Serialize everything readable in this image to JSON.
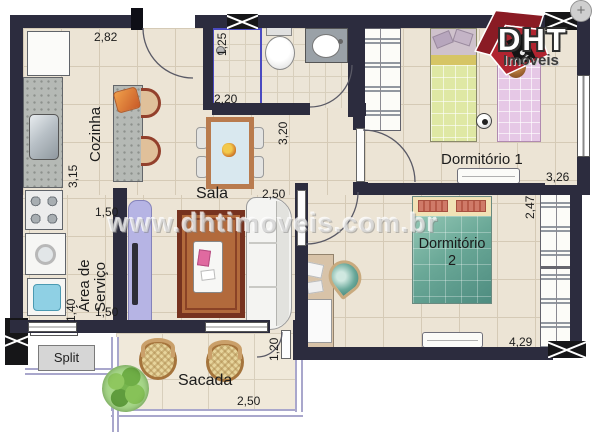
{
  "watermark": "www.dhtimoveis.com.br",
  "logo": {
    "name": "DHT",
    "subtitle": "Imóveis",
    "compass": "+"
  },
  "rooms": {
    "kitchen": {
      "label": "Cozinha",
      "dim_width": "2,82",
      "dim_depth": "3,15"
    },
    "bathroom": {
      "dim_shower": "1,25",
      "dim_width": "2,20"
    },
    "living": {
      "label": "Sala",
      "dim_depth": "3,20",
      "dim_width": "2,50"
    },
    "service": {
      "label_line1": "Área de",
      "label_line2": "Serviço",
      "dim_top": "1,50",
      "dim_side": "1,40",
      "dim_bottom": "1,50"
    },
    "bedroom1": {
      "label": "Dormitório 1",
      "dim_width": "3,26"
    },
    "bedroom2": {
      "label": "Dormitório",
      "number": "2",
      "dim_depth": "2,47",
      "dim_width": "4,29"
    },
    "balcony": {
      "label": "Sacada",
      "dim_door": "1,20",
      "dim_width": "2,50"
    },
    "ac": {
      "label": "Split"
    }
  },
  "colors": {
    "wall": "#2c2c3e",
    "floor": "#ece4d5",
    "accent_red": "#a8232e",
    "shower_line": "#4a4ac0",
    "railing": "#a9a7cc"
  }
}
